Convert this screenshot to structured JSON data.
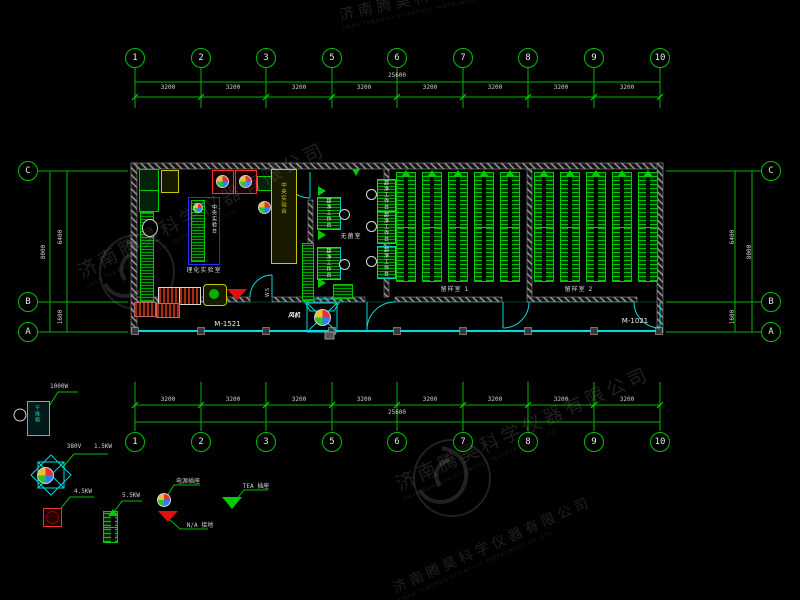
{
  "watermark": {
    "company_cn": "济南腾昊科学仪器有限公司",
    "company_en": "JINAN TENGHAO SCIENTIFIC INSTRUMENT CO.,LTD"
  },
  "grid": {
    "cols": [
      "1",
      "2",
      "3",
      "5",
      "6",
      "7",
      "8",
      "9",
      "10"
    ],
    "rows": [
      "C",
      "B",
      "A"
    ],
    "span_total": "25600",
    "bay": "3200",
    "side_total": "8000",
    "side_upper": "6400",
    "side_lower": "1600"
  },
  "plan": {
    "door_left": "M-1521",
    "door_right": "M-1021",
    "room_left": "理化实验室",
    "room_middle": "无菌室",
    "room_sample1": "留样室 1",
    "room_sample2": "留样室 2",
    "bench_central": "中央实验台",
    "bench_clean": "超净工作台",
    "fan_label": "风机",
    "ws_label": "WS"
  },
  "legend": {
    "oven_text": "干燥箱",
    "oven_power": "1000W",
    "fan_volt": "380V",
    "fan_power": "1.5KW",
    "heater_power": "4.5KW",
    "rack_power": "5.5KW",
    "socket_label": "电源插座",
    "ground_label": "N/A 接地",
    "tea_label": "TEA 插座"
  }
}
